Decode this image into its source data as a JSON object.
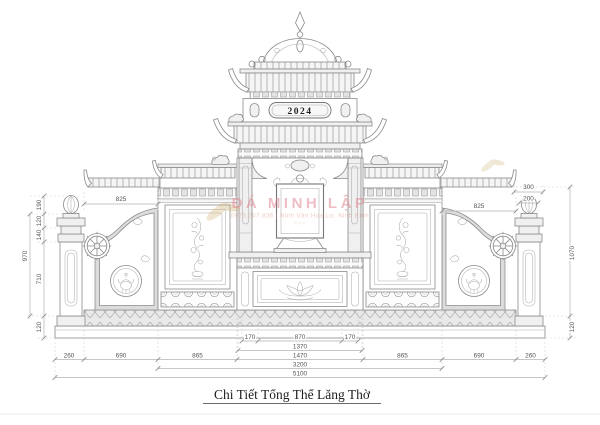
{
  "title": "Chi Tiết Tổng Thể Lăng Thờ",
  "year_plaque": "2024",
  "watermark": {
    "brand": "ĐÁ MINH LẬP",
    "contact": "0973.207.836 | Ninh Vân Hoa Lư, Ninh Bình",
    "website": "www."
  },
  "dims": {
    "top_left_width": "825",
    "pillar_cap_width": "300",
    "pillar_bud_width": "200",
    "top_right_width": "825",
    "left_heights": {
      "finial": "190",
      "cap_upper": "120",
      "cap_lower": "140",
      "shaft": "710",
      "total": "970",
      "base": "120"
    },
    "right_heights": {
      "total": "1070",
      "base": "120"
    },
    "bottom_rows": {
      "row1": [
        "170",
        "870",
        "170"
      ],
      "row2": "1370",
      "row3": [
        "260",
        "690",
        "865",
        "1470",
        "865",
        "690",
        "260"
      ],
      "row4": "3200",
      "row5": "5100"
    }
  },
  "colors": {
    "watermark": "#e08a94",
    "linework": "#8a8a8a",
    "dimension_text": "#555555"
  }
}
